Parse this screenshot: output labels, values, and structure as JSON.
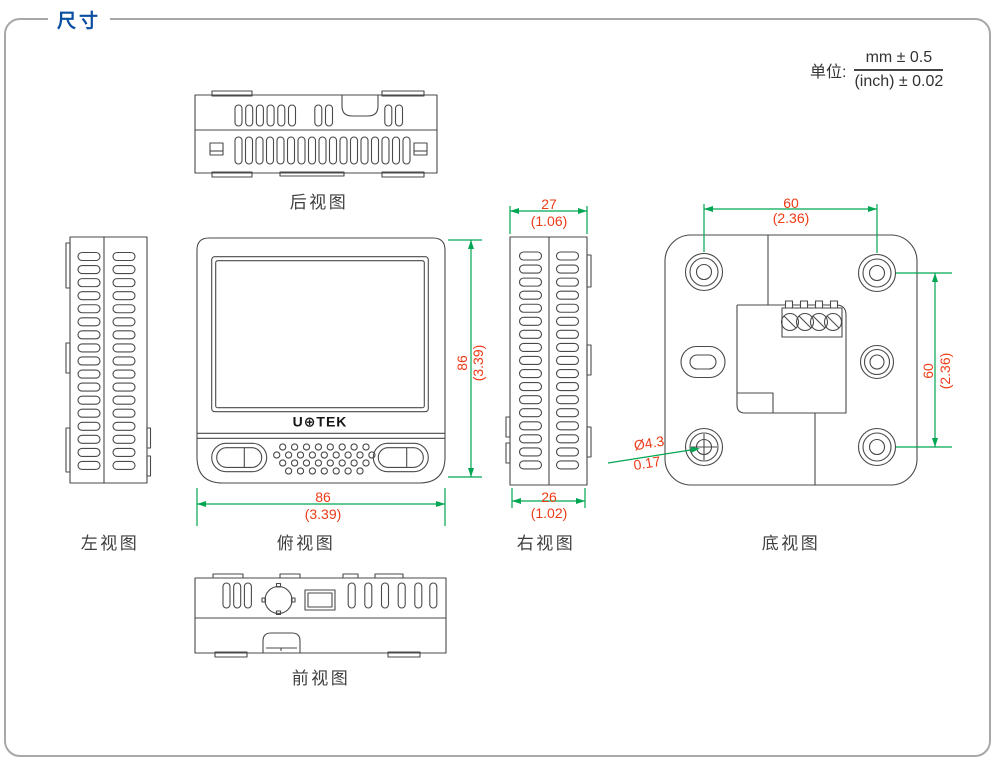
{
  "title": "尺寸",
  "unit": {
    "label": "单位:",
    "mm": "mm ± 0.5",
    "inch": "(inch) ± 0.02"
  },
  "views": {
    "rear": {
      "label": "后视图"
    },
    "left": {
      "label": "左视图"
    },
    "top": {
      "label": "俯视图",
      "logo": "U⊕TEK",
      "width_mm": "86",
      "width_inch": "(3.39)",
      "height_mm": "86",
      "height_inch": "(3.39)"
    },
    "right": {
      "label": "右视图",
      "top_mm": "27",
      "top_inch": "(1.06)",
      "bottom_mm": "26",
      "bottom_inch": "(1.02)"
    },
    "bottom": {
      "label": "底视图",
      "width_mm": "60",
      "width_inch": "(2.36)",
      "height_mm": "60",
      "height_inch": "(2.36)",
      "hole_dia_mm": "Ø4.3",
      "hole_dia_inch": "0.17"
    },
    "front": {
      "label": "前视图"
    }
  },
  "colors": {
    "title_blue": "#0b4ea2",
    "dim_red": "#ed3b18",
    "dim_green": "#00a651",
    "line_gray": "#4a4a4a"
  }
}
